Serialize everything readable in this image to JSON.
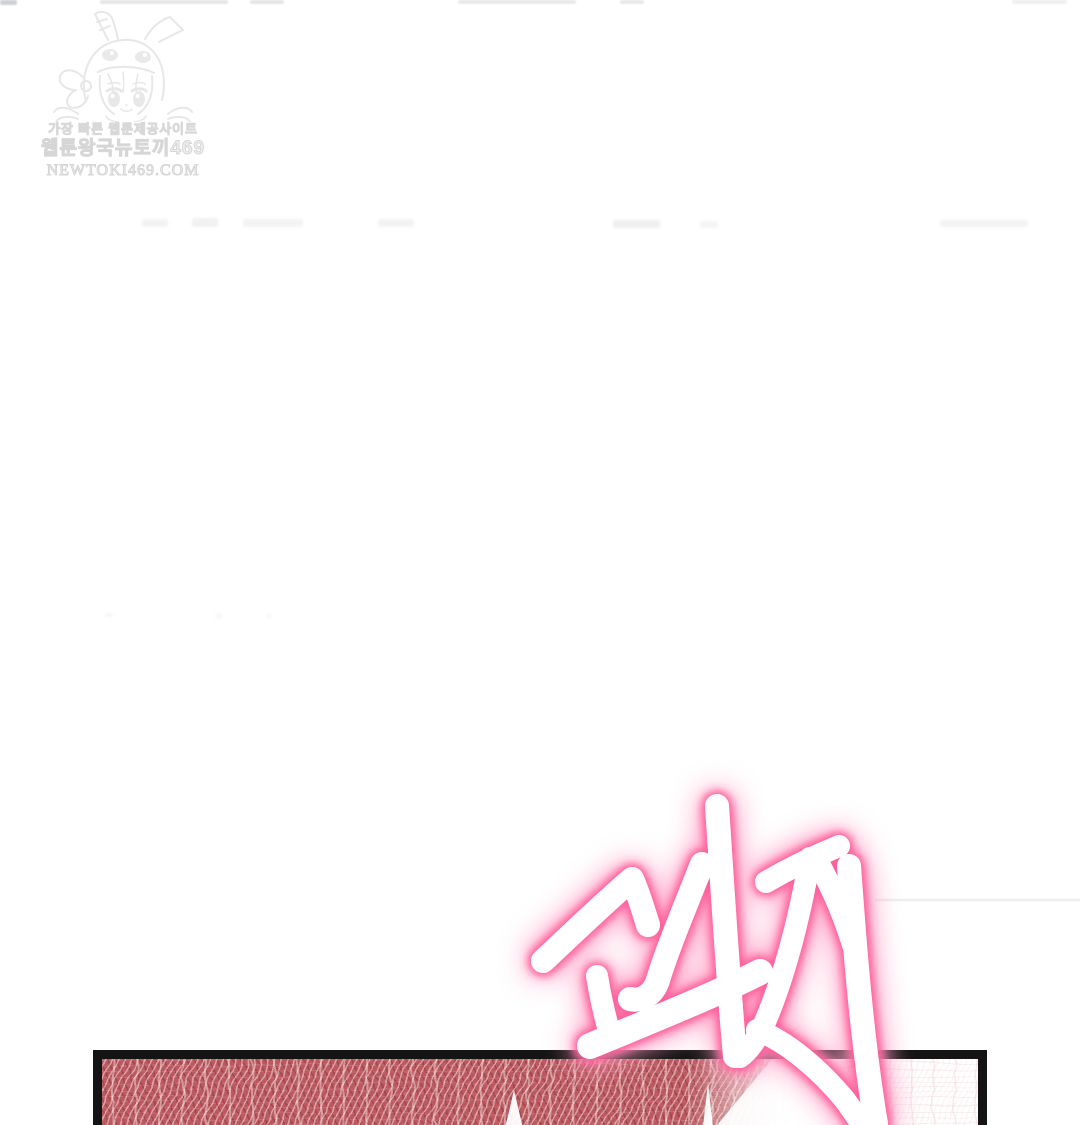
{
  "page": {
    "type": "webtoon-episode-image",
    "bg_color": "#ffffff"
  },
  "watermark": {
    "tagline": "가장 빠른 웹툰제공사이트",
    "site_name": "웹툰왕국뉴토끼469",
    "site_url": "NEWTOKI469.COM",
    "mascot": "bunny-hood-girl-sketch",
    "ink_color": "#d2d2d2"
  },
  "sfx": {
    "text": "꽈직",
    "fill_color": "#ffffff",
    "glow_color": "#ff5f9d",
    "outer_glow_color": "#ff9fc4"
  },
  "panel": {
    "border_color": "#141414",
    "fabric_base_color": "#bb5860",
    "fabric_thread_color": "#f3e6de",
    "content": "red woven fabric close-up fading to white on the right"
  }
}
